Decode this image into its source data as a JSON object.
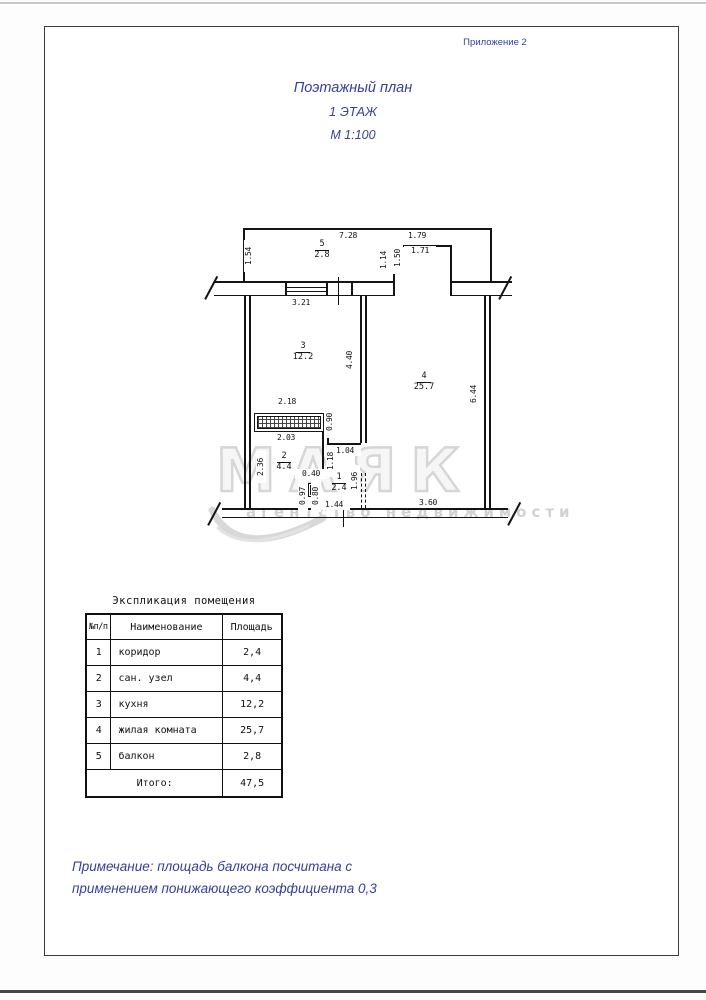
{
  "page": {
    "appendix": "Приложение 2",
    "title_line1": "Поэтажный план",
    "title_line2": "1 ЭТАЖ",
    "title_line3": "М 1:100",
    "note_line1": "Примечание: площадь балкона посчитана с",
    "note_line2": "применением понижающего коэффициента 0,3"
  },
  "colors": {
    "accent_blue": "#35409d",
    "line_black": "#141414",
    "watermark_gray": "#d6d6d6"
  },
  "plan": {
    "watermark_text": "МАЯК",
    "watermark_subtext": "агентство недвижимости",
    "rooms": [
      {
        "num": "5",
        "area": "2.8",
        "x": 322,
        "y": 246
      },
      {
        "num": "3",
        "area": "12.2",
        "x": 303,
        "y": 348
      },
      {
        "num": "4",
        "area": "25.7",
        "x": 424,
        "y": 378
      },
      {
        "num": "2",
        "area": "4.4",
        "x": 284,
        "y": 458
      },
      {
        "num": "1",
        "area": "2.4",
        "x": 339,
        "y": 479
      }
    ],
    "dims": [
      {
        "t": "7.28",
        "x": 348,
        "y": 236
      },
      {
        "t": "1.79",
        "x": 417,
        "y": 236
      },
      {
        "t": "1.71",
        "x": 420,
        "y": 251
      },
      {
        "t": "3.21",
        "x": 301,
        "y": 303
      },
      {
        "t": "2.18",
        "x": 287,
        "y": 402
      },
      {
        "t": "2.03",
        "x": 286,
        "y": 438
      },
      {
        "t": "1.04",
        "x": 345,
        "y": 451
      },
      {
        "t": "0.40",
        "x": 311,
        "y": 474
      },
      {
        "t": "1.44",
        "x": 334,
        "y": 505
      },
      {
        "t": "3.60",
        "x": 428,
        "y": 503
      },
      {
        "t": "1.54",
        "x": 249,
        "y": 256,
        "vert": true
      },
      {
        "t": "1.14",
        "x": 384,
        "y": 260,
        "vert": true
      },
      {
        "t": "1.50",
        "x": 398,
        "y": 258,
        "vert": true
      },
      {
        "t": "4.40",
        "x": 350,
        "y": 360,
        "vert": true
      },
      {
        "t": "6.44",
        "x": 474,
        "y": 394,
        "vert": true
      },
      {
        "t": "0.90",
        "x": 330,
        "y": 422,
        "vert": true
      },
      {
        "t": "2.36",
        "x": 261,
        "y": 467,
        "vert": true
      },
      {
        "t": "1.18",
        "x": 331,
        "y": 461,
        "vert": true
      },
      {
        "t": "1.96",
        "x": 355,
        "y": 481,
        "vert": true
      },
      {
        "t": "0.97",
        "x": 303,
        "y": 496,
        "vert": true
      },
      {
        "t": "0.80",
        "x": 316,
        "y": 496,
        "vert": true
      }
    ]
  },
  "table": {
    "title": "Экспликация помещения",
    "headers": [
      "№п/п",
      "Наименование",
      "Площадь"
    ],
    "rows": [
      {
        "num": "1",
        "name": "коридор",
        "area": "2,4"
      },
      {
        "num": "2",
        "name": "сан. узел",
        "area": "4,4"
      },
      {
        "num": "3",
        "name": "кухня",
        "area": "12,2"
      },
      {
        "num": "4",
        "name": "жилая комната",
        "area": "25,7"
      },
      {
        "num": "5",
        "name": "балкон",
        "area": "2,8"
      }
    ],
    "total_label": "Итого:",
    "total_value": "47,5"
  }
}
